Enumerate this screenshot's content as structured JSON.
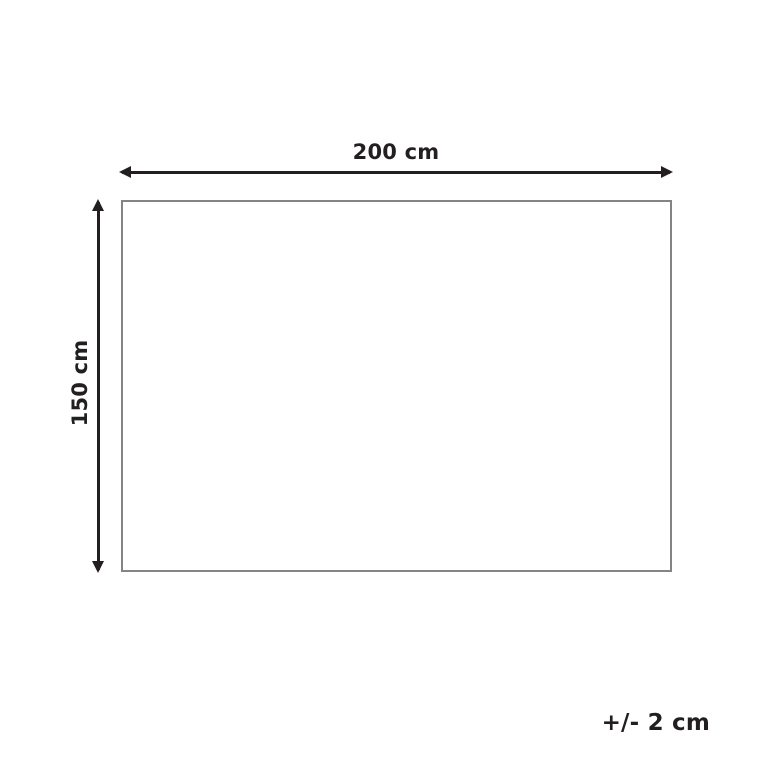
{
  "diagram": {
    "type": "product-dimension-diagram",
    "width_label": "200 cm",
    "height_label": "150 cm",
    "tolerance_label": "+/- 2 cm",
    "colors": {
      "arrow_and_text": "#231f20",
      "rectangle_border": "#848484",
      "background": "#ffffff"
    }
  }
}
